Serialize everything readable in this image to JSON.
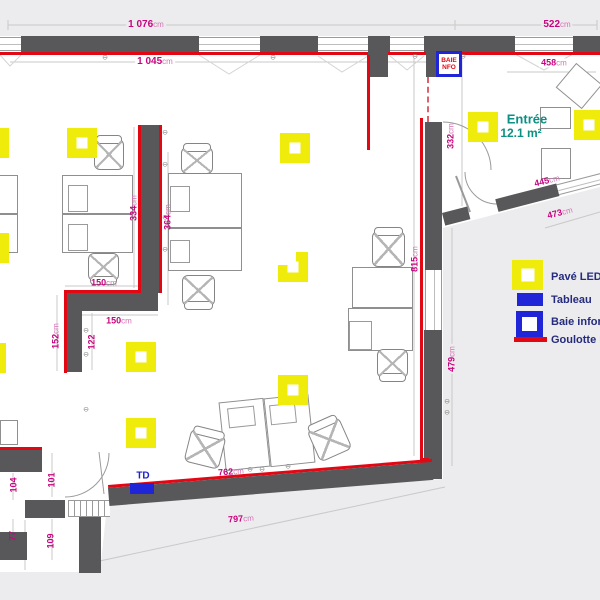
{
  "colors": {
    "wall": "#58585a",
    "goulotte_red": "#e30613",
    "led_yellow": "#efeb0b",
    "tableau_blue": "#2125d8",
    "dimension_magenta": "#c6057f",
    "room_teal": "#0a9184",
    "legend_navy": "#252c7e",
    "exterior_gray": "#ecebed"
  },
  "icons": {
    "socket": "⊖"
  },
  "dimensions": {
    "top_outer": {
      "v": "1 076",
      "u": "cm"
    },
    "top_right": {
      "v": "522",
      "u": "cm"
    },
    "top_inner": {
      "v": "1 045",
      "u": "cm"
    },
    "entree_width": {
      "v": "458",
      "u": "cm"
    },
    "entree_height": {
      "v": "332",
      "u": "cm"
    },
    "wall_334": {
      "v": "334",
      "u": "cm"
    },
    "wall_364": {
      "v": "364",
      "u": "cm"
    },
    "desk_150_a": {
      "v": "150",
      "u": "cm"
    },
    "desk_150_b": {
      "v": "150",
      "u": "cm"
    },
    "wall_152": {
      "v": "152",
      "u": "cm"
    },
    "wall_122": {
      "v": "122",
      "u": ""
    },
    "alcove_101": {
      "v": "101",
      "u": ""
    },
    "alcove_104": {
      "v": "104",
      "u": ""
    },
    "alcove_77": {
      "v": "77",
      "u": ""
    },
    "alcove_109": {
      "v": "109",
      "u": ""
    },
    "right_815": {
      "v": "815",
      "u": "cm"
    },
    "right_479": {
      "v": "479",
      "u": "cm"
    },
    "bottom_inner": {
      "v": "762",
      "u": "cm"
    },
    "bottom_outer": {
      "v": "797",
      "u": "cm"
    },
    "entree_bot_inner": {
      "v": "445",
      "u": "cm"
    },
    "entree_bot_outer": {
      "v": "473",
      "u": "cm"
    }
  },
  "rooms": {
    "entree": {
      "name": "Entrée",
      "area": "12.1 m²"
    }
  },
  "labels": {
    "td": "TD",
    "baie_line1": "BAIE",
    "baie_line2": "NFO"
  },
  "legend": {
    "items": [
      {
        "key": "led",
        "label": "Pavé LED"
      },
      {
        "key": "tableau",
        "label": "Tableau"
      },
      {
        "key": "baie",
        "label": "Baie inform"
      },
      {
        "key": "goulotte",
        "label": "Goulotte D"
      }
    ]
  }
}
